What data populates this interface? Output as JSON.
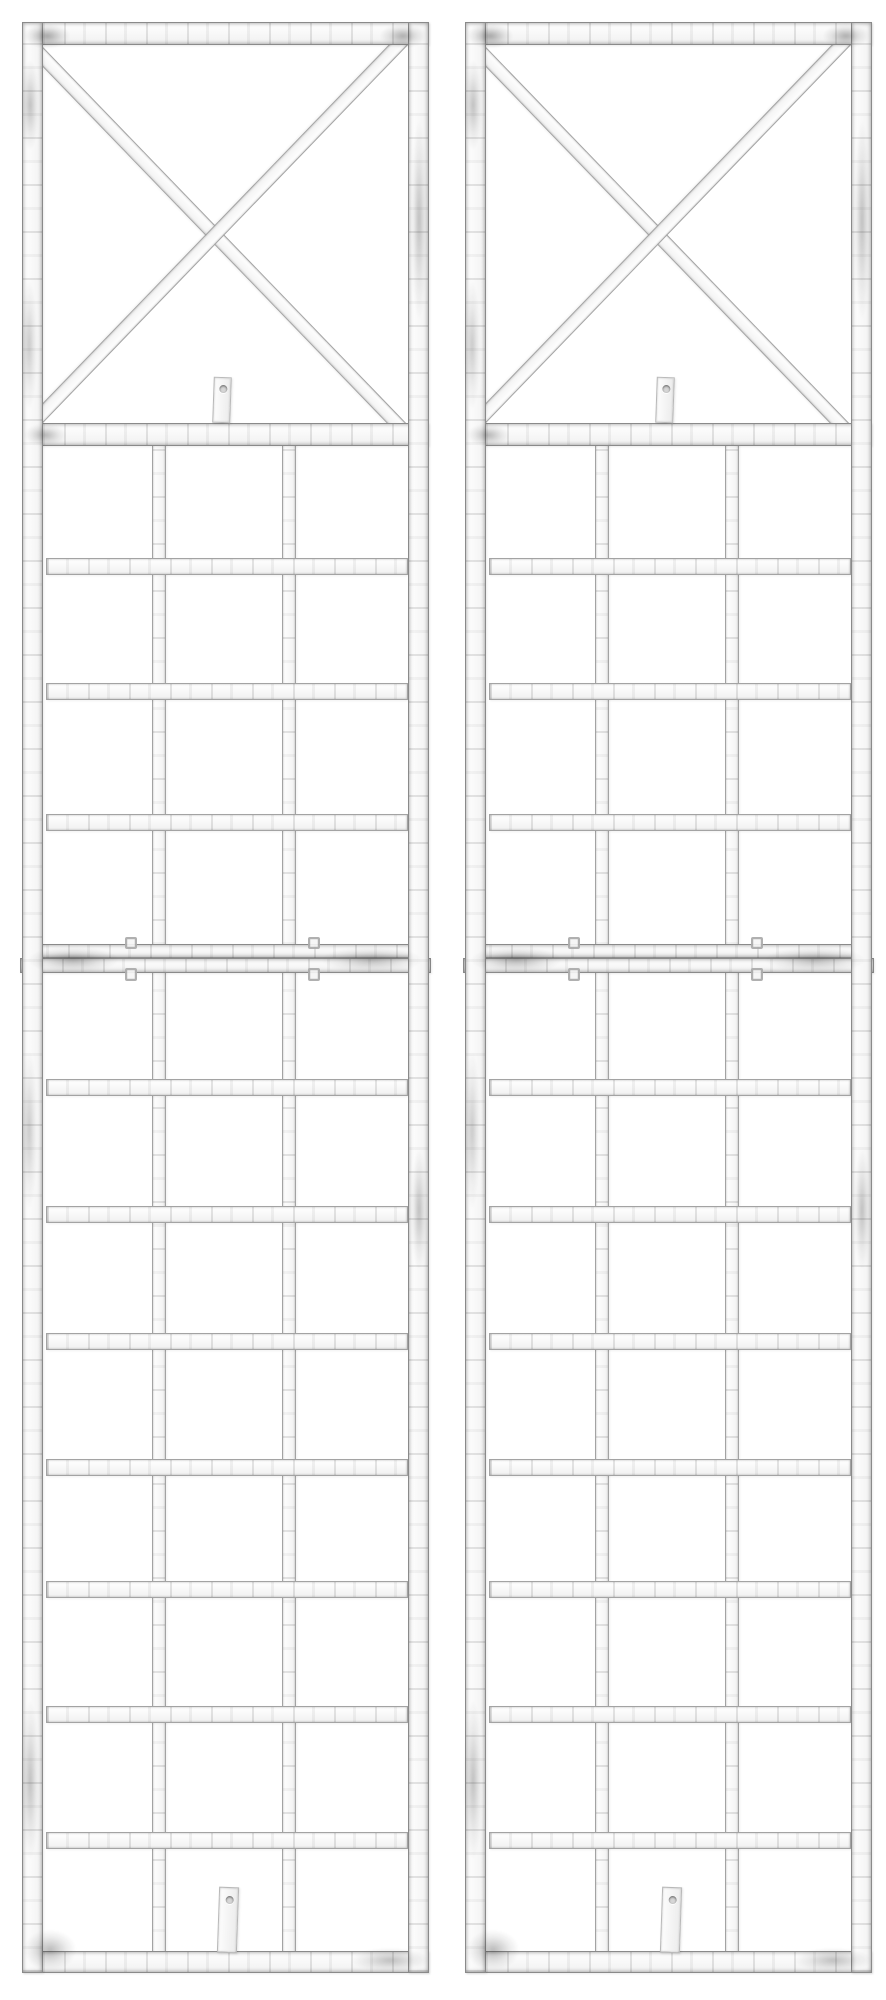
{
  "scene": {
    "description": "Product photo: two identical white shabby-chic distressed metal wall trellis panels side by side on a plain white background. Each panel has a square X-cross braced top section and a rectangular lattice grid below, joined in the middle by a double crossbar with wire clips, with two small screw-hole mounting tabs.",
    "background_color": "#ffffff",
    "panel_count": 2,
    "panel_labels": [
      "trellis-panel-left",
      "trellis-panel-right"
    ]
  },
  "colors": {
    "bar_fill": "#ffffff",
    "bar_fill_shade": "#f1f1f1",
    "bar_edge": "#a3a3a3",
    "bar_edge_dark": "#8a8a8a",
    "grime": "#232323",
    "hole_fill": "#d6d6d6"
  },
  "geometry": {
    "image_width": 886,
    "image_height": 2000,
    "panel_offsets_x": [
      22,
      465
    ],
    "panel_width": 407,
    "panel_top": 22,
    "panel_bottom": 1973,
    "frame_thickness": 21,
    "top_bar": {
      "y": 22,
      "h": 23
    },
    "xbox_bottom_bar": {
      "y": 423,
      "h": 23
    },
    "junction_bars": [
      {
        "name": "junction-bar-upper",
        "x": 4,
        "y": 944,
        "w": 399,
        "h": 15
      },
      {
        "name": "junction-bar-lower",
        "x": -2,
        "y": 958,
        "w": 411,
        "h": 15
      }
    ],
    "bottom_bar": {
      "y": 1951,
      "h": 22
    },
    "vertical_bars": [
      {
        "x": 130,
        "w": 14
      },
      {
        "x": 260,
        "w": 14
      }
    ],
    "vertical_bars_top": 440,
    "vertical_bars_bottom": 1956,
    "horizontal_bars": {
      "x": 24,
      "w": 362,
      "h": 17,
      "tops": [
        558,
        683,
        814,
        1079,
        1206,
        1333,
        1459,
        1581,
        1706,
        1832
      ]
    },
    "diagonal": {
      "left_x": 21,
      "right_x": 386,
      "top_y": 45,
      "length": 526,
      "width": 14,
      "angle_deg": 46
    },
    "tabs": [
      {
        "name": "upper-mount-tab",
        "x": 191,
        "y": 377,
        "w": 18,
        "h": 46,
        "rotate": 2,
        "hole": {
          "cx": 9,
          "cy": 11,
          "r": 4
        }
      },
      {
        "name": "lower-mount-tab",
        "x": 196,
        "y": 1887,
        "w": 20,
        "h": 66,
        "rotate": 2,
        "hole": {
          "cx": 10,
          "cy": 12,
          "r": 4
        }
      }
    ],
    "junction_clips": [
      {
        "x": 103,
        "y": 937,
        "w": 12,
        "h": 12
      },
      {
        "x": 286,
        "y": 937,
        "w": 12,
        "h": 12
      },
      {
        "x": 103,
        "y": 968,
        "w": 12,
        "h": 13
      },
      {
        "x": 286,
        "y": 968,
        "w": 12,
        "h": 13
      }
    ],
    "grime_spots": [
      {
        "x": 2,
        "y": 24,
        "w": 46,
        "h": 24,
        "o": 0.42
      },
      {
        "x": 358,
        "y": 24,
        "w": 46,
        "h": 24,
        "o": 0.38
      },
      {
        "x": -1,
        "y": 60,
        "w": 18,
        "h": 90,
        "o": 0.3
      },
      {
        "x": 389,
        "y": 120,
        "w": 16,
        "h": 200,
        "o": 0.3
      },
      {
        "x": -1,
        "y": 280,
        "w": 16,
        "h": 130,
        "o": 0.26
      },
      {
        "x": 2,
        "y": 424,
        "w": 42,
        "h": 22,
        "o": 0.34
      },
      {
        "x": 6,
        "y": 947,
        "w": 90,
        "h": 26,
        "o": 0.34
      },
      {
        "x": 300,
        "y": 947,
        "w": 100,
        "h": 26,
        "o": 0.3
      },
      {
        "x": -1,
        "y": 1050,
        "w": 16,
        "h": 160,
        "o": 0.26
      },
      {
        "x": 389,
        "y": 1150,
        "w": 16,
        "h": 120,
        "o": 0.3
      },
      {
        "x": -1,
        "y": 1700,
        "w": 18,
        "h": 160,
        "o": 0.3
      },
      {
        "x": 2,
        "y": 1930,
        "w": 52,
        "h": 40,
        "o": 0.34
      },
      {
        "x": 330,
        "y": 1948,
        "w": 76,
        "h": 24,
        "o": 0.3
      }
    ]
  }
}
